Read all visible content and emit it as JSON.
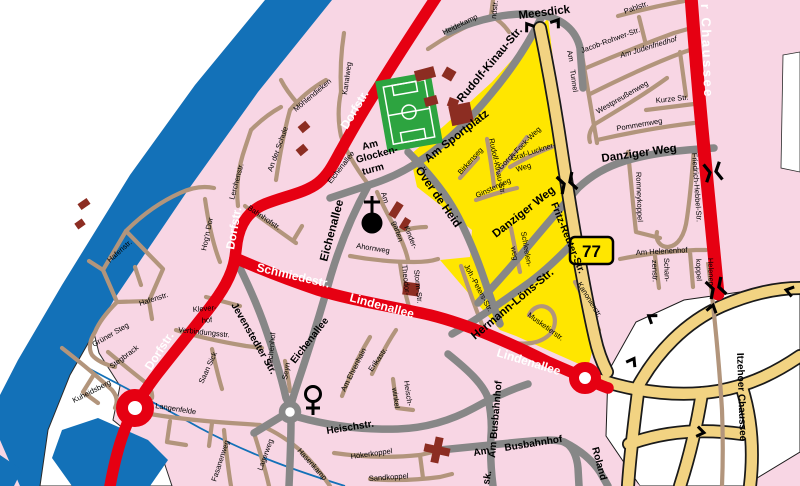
{
  "map_type": "city-street-map",
  "route_badge": {
    "number": "77"
  },
  "colors": {
    "residential_pink": "#f8d6e4",
    "water_blue": "#1371b8",
    "district_yellow": "#ffe600",
    "major_road_red": "#e60012",
    "secondary_road_gray": "#878787",
    "minor_road_brown": "#b2957c",
    "highway_beige": "#f2d382",
    "building_red": "#8c2d22",
    "sports_green": "#2da440",
    "unmapped_white": "#ffffff"
  },
  "labels": {
    "dorfstr_a": "Dorfstr.",
    "dorfstr_b": "Dorfstr.",
    "dorfstr_c": "Dorfstr.",
    "schmiedestr": "Schmiedestr.",
    "lindenallee_a": "Lindenallee",
    "lindenallee_b": "Lindenallee",
    "chaussee_top": "r Chaussee",
    "meesdick": "Meesdick",
    "am_sportplatz": "Am Sportplatz",
    "rudolf_kinau_big": "Rudolf-Kinau-Str.",
    "oever_de_heid": "Över de Heid",
    "danziger_weg_a": "Danziger Weg",
    "danziger_weg_b": "Danziger Weg",
    "hermann_loens": "Hermann-Löns-Str.",
    "fritz_reuter": "Fritz-Reuter-Str.",
    "heischstr": "Heischstr.",
    "jevenstedter": "Jevenstedter Str.",
    "eichenallee_big": "Eichenallee",
    "eichenallee_small": "Eichenallee",
    "eichenallee_south": "Eichenallee",
    "glocken_am": "Am",
    "glocken_mid": "Glocken-",
    "glocken_turm": "turm",
    "am_busbahnhof_v": "Am Busbahnhof",
    "am_h": "Am",
    "busbahnhof_h": "Busbahnhof",
    "roland": "Roland",
    "sk": "sk.",
    "itzehoer_chaussee": "Itzehoer Chaussee",
    "heidekamp": "Heidekamp",
    "ndstr": "ndstr.",
    "kanalweg": "Kanalweg",
    "moehlendieken": "Möhlendieken",
    "an_der_schule": "An der Schule",
    "lerchenstr": "Lerchenstr.",
    "hogn_dor": "Hog'n Dor",
    "hafenstr_a": "Hafenstr.",
    "hafenstr_b": "Hafenstr.",
    "gruener_steg": "Grüner Steg",
    "stegbrack": "Stegbrack",
    "kuheidsberg": "Kuheidsberg",
    "langenfelde": "Langenfelde",
    "fasanenweg": "Fasanenweg",
    "lagerweg": "Lagerweg",
    "hasenkamp": "Hasenkamp",
    "klever": "Klever-",
    "hof": "hof",
    "verbindungsstr": "Verbindungsstr.",
    "saan_sick": "Saan Sick",
    "eichenhof": "Eichenhof",
    "seyn": "Seyn",
    "bahnhofstr": "Bahnhofstr.",
    "ahornweg": "Ahornweg",
    "theodor": "Theodor-",
    "storm_str": "Storm-Str.",
    "am_garten_1": "Am",
    "am_garten_2": "garten",
    "kinder": "Kinder-",
    "erikastr": "Erikastr.",
    "am_ehrenhain": "Am Ehrenhain",
    "heisch": "Heisch-",
    "winkel": "winkel",
    "hoekerkoppel": "Hökerkoppel",
    "sandkoppel": "Sandkoppel",
    "birkenseg": "Birkenseg",
    "ginsterweg": "Ginsterweg",
    "gorch_fock": "Gorch-Fock-Weg",
    "graf_luckner": "Graf-Luckner-",
    "graf_weg": "Weg",
    "rudolf_kinau_small": "Rudolf-Kinau-Str.",
    "schleelen": "Schleelen-",
    "schleelen_weg": "weg",
    "joh_peters": "Joh.-Peters-Str.",
    "musketierstr": "Musketierstr.",
    "kanonierstr": "Kanonierstr.",
    "pahlstr": "Pahlstr.",
    "jacob_rohwer": "Jacob-Rohwer-Str.",
    "am_judenfriedhof": "Am Judenfriedhof",
    "am_tunnel_1": "Am",
    "am_tunnel_2": "Tunnel",
    "westpreussenweg": "Westpreußenweg",
    "kurze_str": "Kurze Str.",
    "pommernweg": "Pommernweg",
    "friedrich_hebbel": "Friedrich-Hebbel-Str.",
    "romneykoppel": "Romneykoppel",
    "am_helenenhof": "Am Helenenhof",
    "schan": "Schan-",
    "zenstr": "zenstr.",
    "helenen": "Helenen-",
    "koppel": "koppel"
  }
}
